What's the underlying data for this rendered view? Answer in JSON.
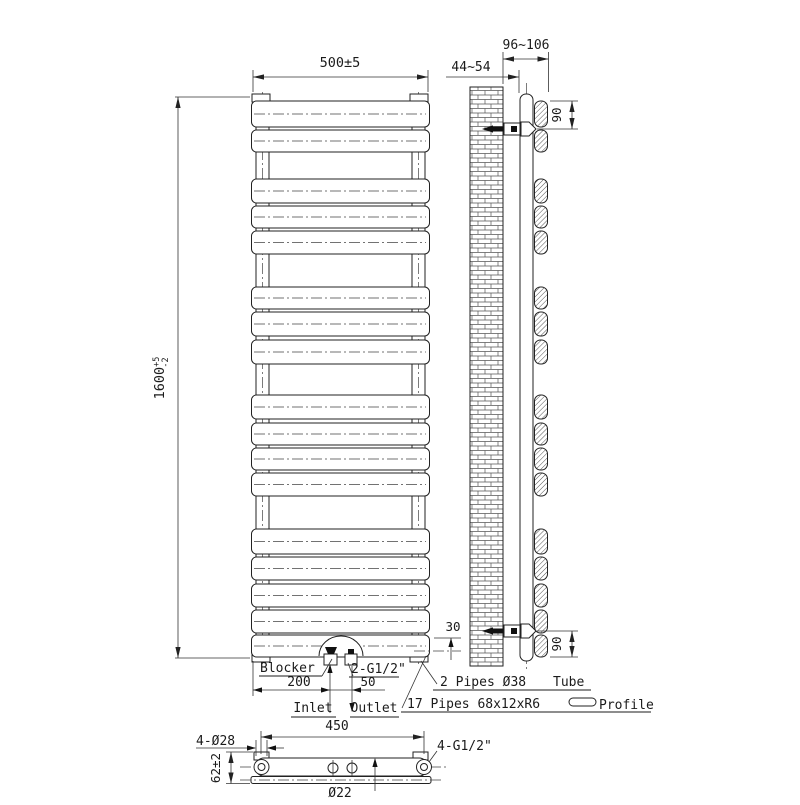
{
  "front_view": {
    "width_dim": "500±5",
    "height_dim_value": "1600",
    "height_dim_tol_upper": "+5",
    "height_dim_tol_lower": "-2",
    "blocker_label": "Blocker",
    "inlet_offset_dim": "200",
    "inlet_outlet_spacing_dim": "50",
    "connections_label": "2-G1/2\"",
    "inlet_label": "Inlet",
    "outlet_label": "Outlet",
    "bottom_clearance_dim": "30"
  },
  "side_view": {
    "wall_to_tube_dim": "44~54",
    "wall_to_panel_dim": "96~106",
    "top_bracket_dim": "90",
    "bottom_bracket_dim": "90"
  },
  "callouts": {
    "vertical_tubes_spec": "2 Pipes Ø38",
    "tube_label": "Tube",
    "flat_pipes_spec": "17 Pipes 68x12xR6",
    "profile_label": "Profile"
  },
  "bottom_view": {
    "connections_span_dim": "450",
    "mounting_holes_label": "4-Ø28",
    "connections_label": "4-G1/2\"",
    "depth_dim": "62±2",
    "pipe_diameter": "Ø22"
  }
}
